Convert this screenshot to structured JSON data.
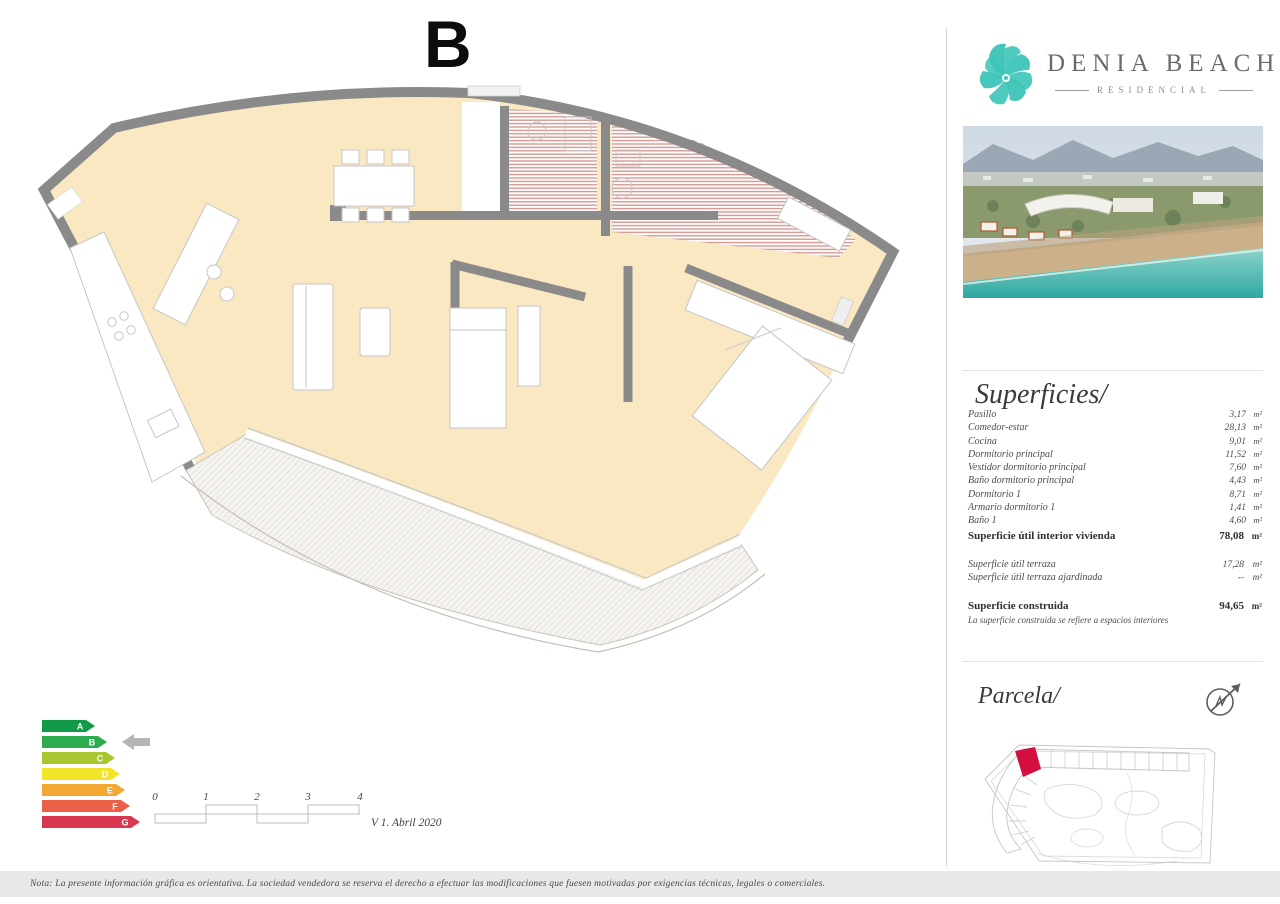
{
  "page": {
    "title_letter": "B",
    "version": "V 1. Abril 2020",
    "footer_note": "Nota: La presente información gráfica es orientativa. La sociedad vendedora se reserva el derecho a efectuar las modificaciones que fuesen motivadas por exigencias técnicas, legales o comerciales."
  },
  "brand": {
    "name": "DENIA BEACH",
    "tagline": "RESIDENCIAL",
    "accent_color": "#3cc4b7"
  },
  "superficies": {
    "heading": "Superficies/",
    "unit": "m²",
    "rooms": [
      {
        "label": "Pasillo",
        "value": "3,17"
      },
      {
        "label": "Comedor-estar",
        "value": "28,13"
      },
      {
        "label": "Cocina",
        "value": "9,01"
      },
      {
        "label": "Dormitorio principal",
        "value": "11,52"
      },
      {
        "label": "Vestidor dormitorio principal",
        "value": "7,60"
      },
      {
        "label": "Baño dormitorio principal",
        "value": "4,43"
      },
      {
        "label": "Dormitorio 1",
        "value": "8,71"
      },
      {
        "label": "Armario dormitorio 1",
        "value": "1,41"
      },
      {
        "label": "Baño 1",
        "value": "4,60"
      }
    ],
    "totals": {
      "interior": {
        "label": "Superficie útil interior vivienda",
        "value": "78,08",
        "unit": "m²"
      },
      "terraza": {
        "label": "Superficie útil terraza",
        "value": "17,28",
        "unit": "m²"
      },
      "ajardinada": {
        "label": "Superficie útil terraza ajardinada",
        "value": "--",
        "unit": "m²"
      },
      "construida": {
        "label": "Superficie construida",
        "value": "94,65",
        "unit": "m²"
      },
      "construida_note": "La superficie construida se refiere a espacios interiores"
    }
  },
  "energy": {
    "grades": [
      {
        "letter": "A",
        "color": "#119a48"
      },
      {
        "letter": "B",
        "color": "#2dab4f"
      },
      {
        "letter": "C",
        "color": "#a8c62f"
      },
      {
        "letter": "D",
        "color": "#f2e428"
      },
      {
        "letter": "E",
        "color": "#f2a832"
      },
      {
        "letter": "F",
        "color": "#eb6147"
      },
      {
        "letter": "G",
        "color": "#d8374f"
      }
    ],
    "selected": "B",
    "pointer_color": "#b5b5b5"
  },
  "scale_bar": {
    "ticks": [
      "0",
      "1",
      "2",
      "3",
      "4"
    ]
  },
  "parcela": {
    "heading": "Parcela/",
    "highlight_color": "#d40f3f"
  },
  "plan_colors": {
    "floor": "#f9e8c2",
    "wall": "#8a8a8a",
    "terrace_line": "#c9c4ba"
  }
}
